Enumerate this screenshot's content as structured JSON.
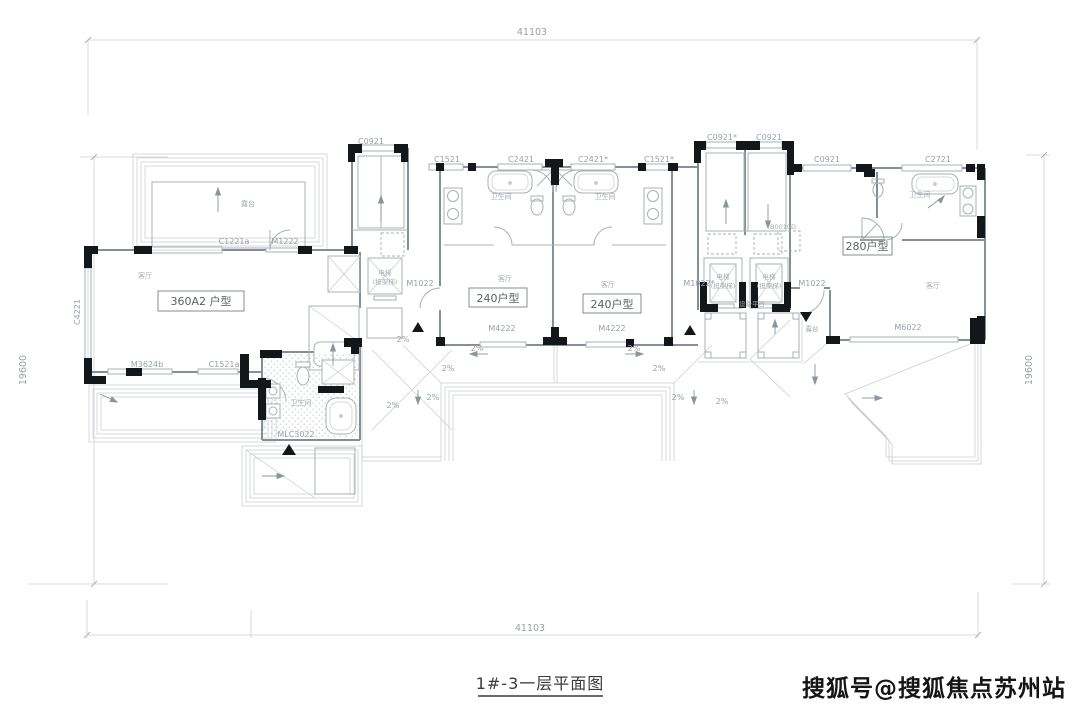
{
  "title": {
    "text": "1#-3一层平面图"
  },
  "watermark": {
    "text": "搜狐号@搜狐焦点苏州站"
  },
  "dimensions": {
    "top": "41103",
    "bottom": "41103",
    "left": "19600",
    "right": "19600"
  },
  "units": [
    {
      "label": "360A2 户型"
    },
    {
      "label": "240户型"
    },
    {
      "label": "240户型"
    },
    {
      "label": "280户型"
    }
  ],
  "openings": [
    {
      "code": "C0921"
    },
    {
      "code": "C1521"
    },
    {
      "code": "C2421"
    },
    {
      "code": "C2421*"
    },
    {
      "code": "C1521*"
    },
    {
      "code": "C0921*"
    },
    {
      "code": "C0921"
    },
    {
      "code": "C0921"
    },
    {
      "code": "C2721"
    },
    {
      "code": "M1022"
    },
    {
      "code": "M1022*"
    },
    {
      "code": "M1022"
    },
    {
      "code": "M4222"
    },
    {
      "code": "M4222"
    },
    {
      "code": "M6022"
    },
    {
      "code": "M3624b"
    },
    {
      "code": "C1521a"
    },
    {
      "code": "MLC3022"
    },
    {
      "code": "C4221"
    },
    {
      "code": "C1221a"
    },
    {
      "code": "M1222"
    },
    {
      "code": "B0010D"
    }
  ],
  "slope_label": "2%",
  "rooms": {
    "bath": "卫生间",
    "elevator": "电梯",
    "stretcher": "(担架梯)",
    "platform": "设备平台",
    "terrace": "露台",
    "living": "客厅"
  },
  "colors": {
    "line": "#c6cbd1",
    "medium": "#a9b0b7",
    "wall": "#878f96",
    "black": "#14171a",
    "label": "#99a1a8",
    "title": "#3a3a3a"
  }
}
